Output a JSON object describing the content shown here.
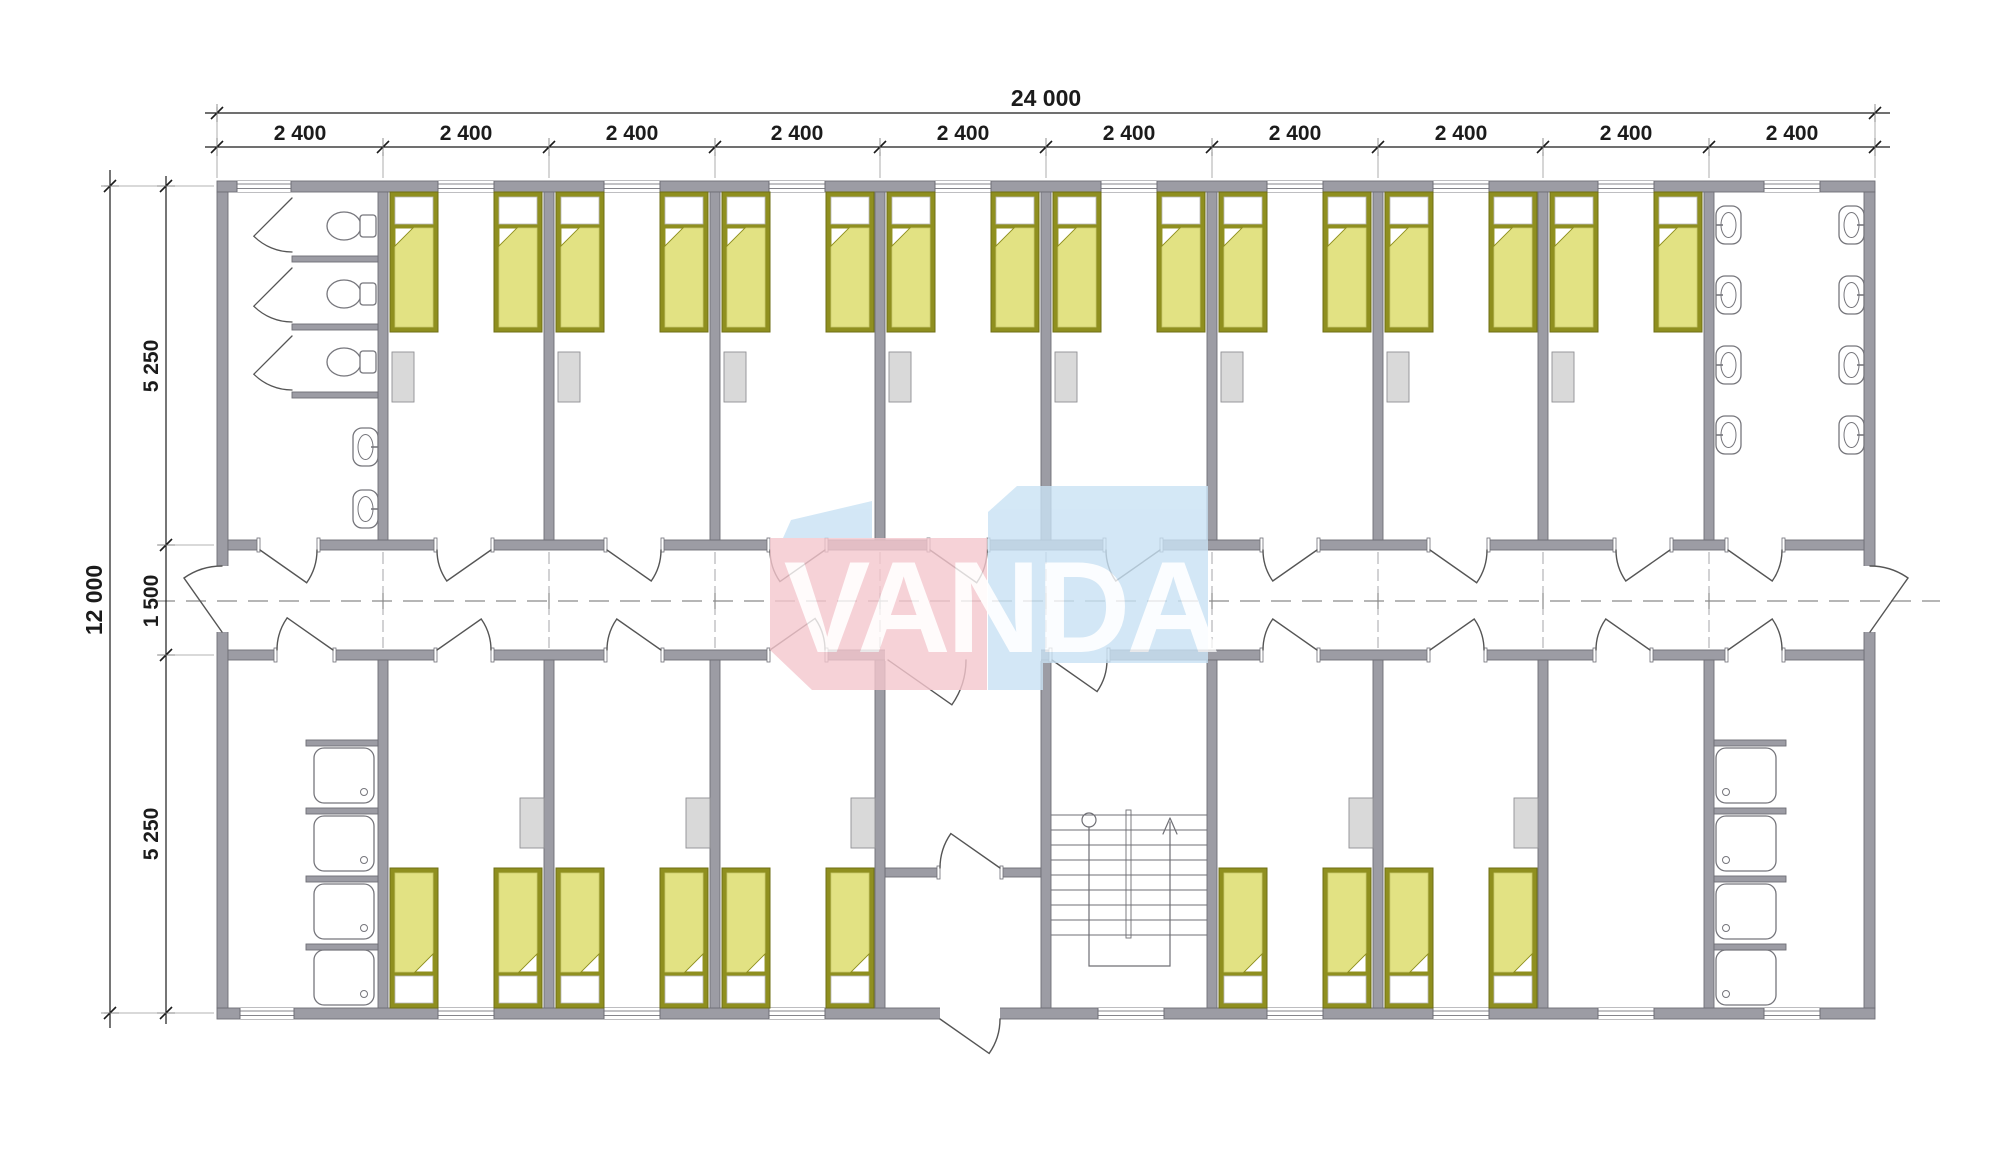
{
  "document": {
    "type": "architectural-floor-plan",
    "background": "#ffffff"
  },
  "dimensions": {
    "top_total": "24 000",
    "top_modules": [
      "2 400",
      "2 400",
      "2 400",
      "2 400",
      "2 400",
      "2 400",
      "2 400",
      "2 400",
      "2 400",
      "2 400"
    ],
    "left_total": "12 000",
    "left_segments": [
      "5 250",
      "1 500",
      "5 250"
    ]
  },
  "watermark": {
    "text": "VANDA",
    "pink": "#f5c7ce",
    "blue": "#c9e2f4",
    "letter_color": "#ffffff"
  },
  "colors": {
    "wall": "#9c9ca4",
    "wall_edge": "#6e6e76",
    "bed_frame": "#8f8f1f",
    "bed_frame_edge": "#6f6f14",
    "bed_blanket": "#e2e283",
    "bed_sheet": "#ffffff",
    "furniture": "#d9d9d9",
    "furniture_edge": "#8f8f93",
    "fixture_line": "#76767c",
    "door": "#555555",
    "centerline": "#8a8a8a",
    "dimension": "#1b1b1b",
    "extension": "#9a9a9a"
  },
  "plan_contents": {
    "bedrooms_top": 8,
    "bedrooms_bottom": 6,
    "beds": 26,
    "wc_stalls": 3,
    "wc_room_sinks": 2,
    "washroom_sinks": 8,
    "shower_stalls": 8,
    "lockers": 13,
    "staircases": 1,
    "exterior_doors": 3,
    "corridor_doors": 22
  }
}
